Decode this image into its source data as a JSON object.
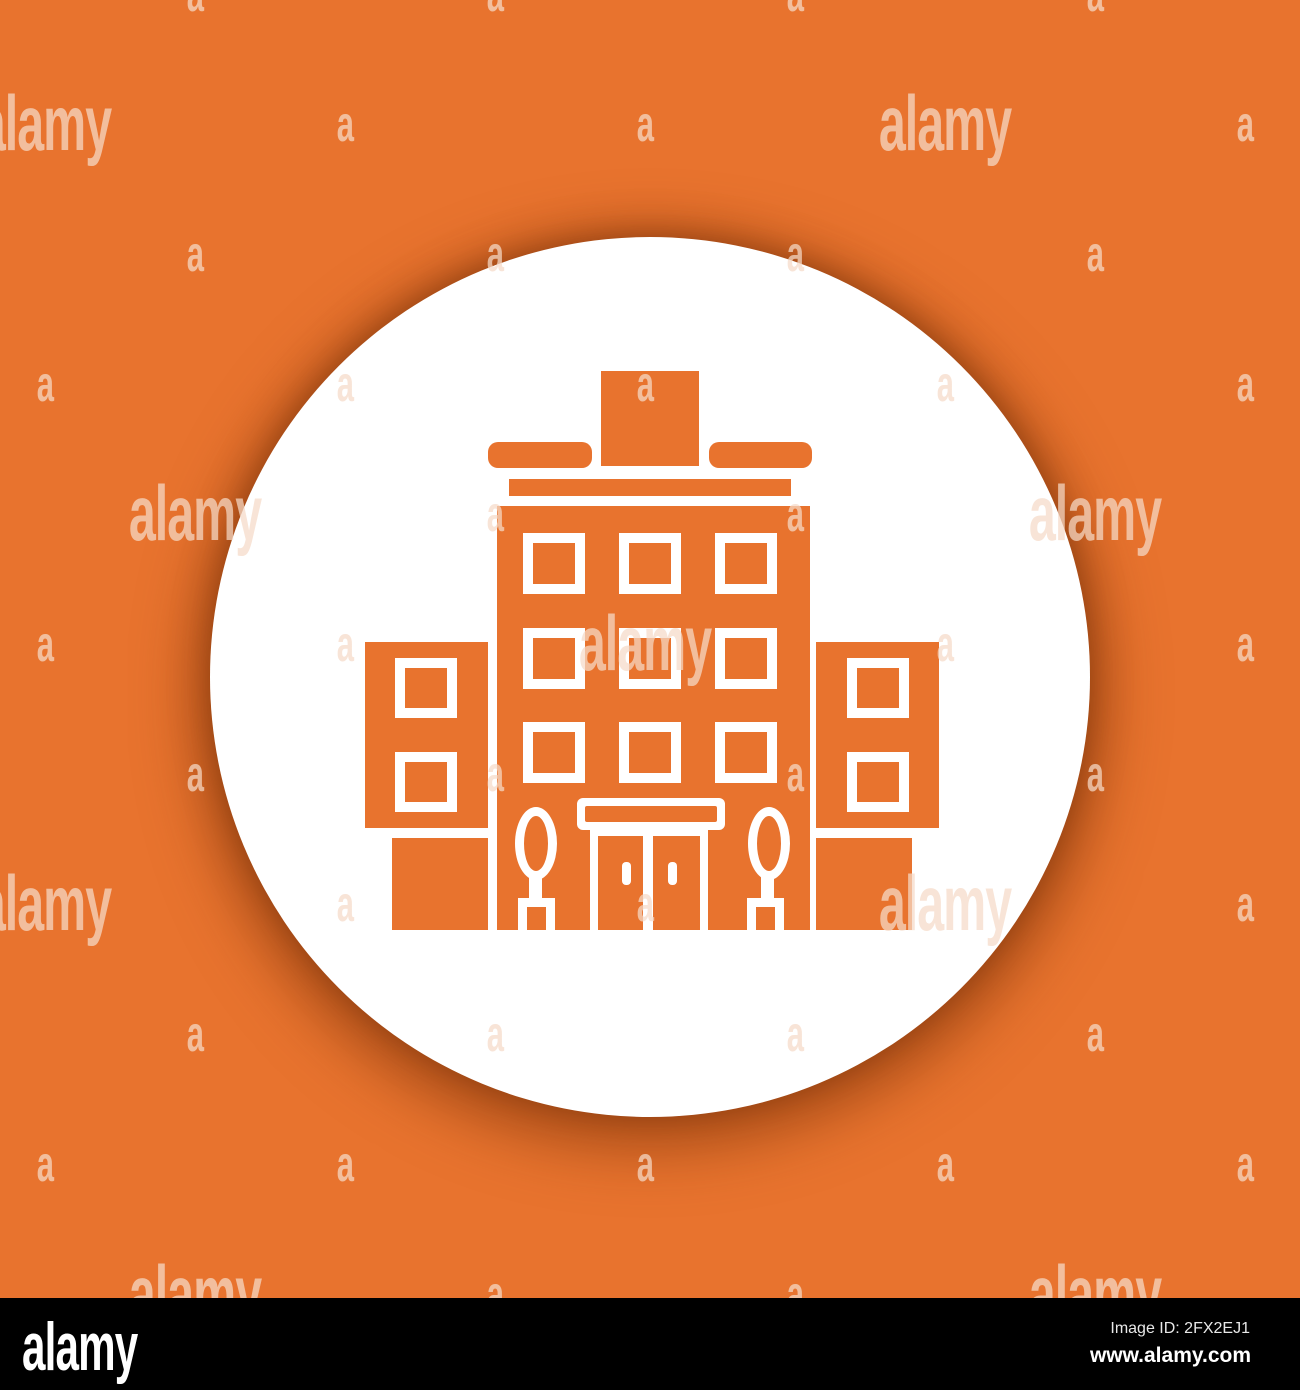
{
  "colors": {
    "background_orange": "#E8732E",
    "icon_orange": "#E8732E",
    "circle_white": "#FFFFFF",
    "shadow_tint": "rgba(125,52,10,0.5)",
    "footer_bar": "#000000",
    "watermark_tint": "#F6DBC8"
  },
  "watermark": {
    "small_text": "a",
    "logo_text": "alamy",
    "opacity": 0.72,
    "rows": 11,
    "row_step": 130,
    "row_offset": -4,
    "even_cols": [
      195,
      495,
      795,
      1095
    ],
    "odd_cols": [
      45,
      345,
      645,
      945,
      1245
    ],
    "logo_positions": [
      [
        1,
        45
      ],
      [
        1,
        945
      ],
      [
        4,
        195
      ],
      [
        4,
        1095
      ],
      [
        5,
        645
      ],
      [
        7,
        45
      ],
      [
        7,
        945
      ],
      [
        10,
        195
      ],
      [
        10,
        1095
      ]
    ]
  },
  "icon": {
    "name": "apartment-building-glyph",
    "description": "orange multi-storey building glyph in white circle"
  },
  "footer": {
    "logo": "alamy",
    "image_id": "Image ID: 2FX2EJ1",
    "url": "www.alamy.com"
  }
}
